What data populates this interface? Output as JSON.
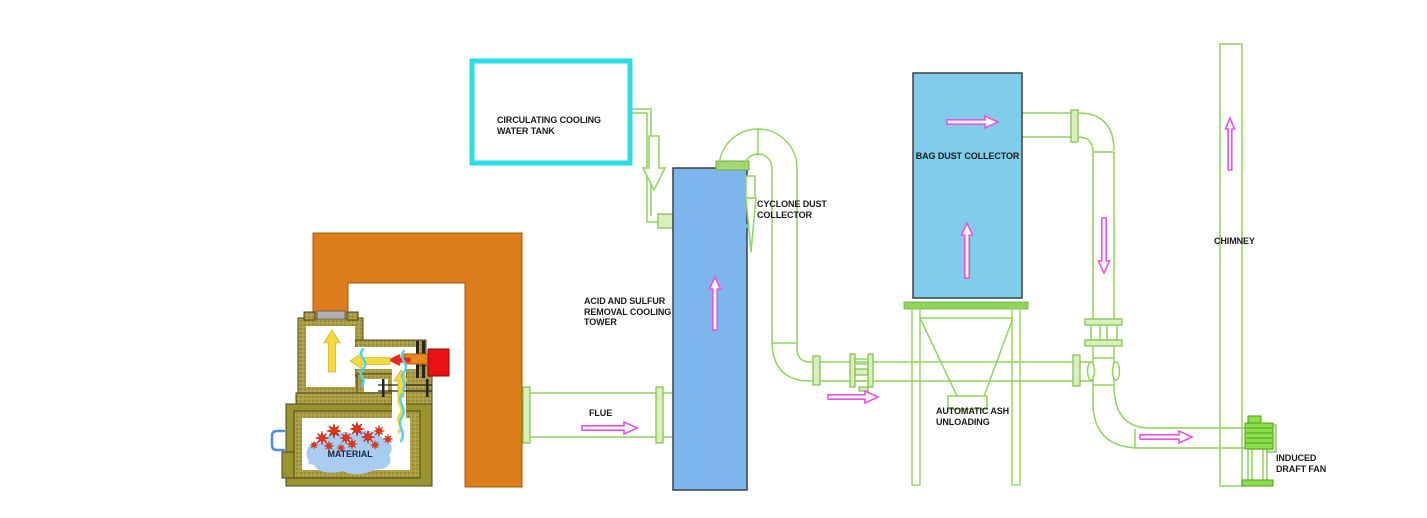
{
  "diagram": {
    "type": "process-flow",
    "background": "#ffffff",
    "components": {
      "water_tank": {
        "label": "CIRCULATING COOLING\nWATER TANK"
      },
      "cooling_tower": {
        "label": "ACID AND SULFUR\nREMOVAL COOLING\nTOWER"
      },
      "cyclone": {
        "label": "CYCLONE DUST\nCOLLECTOR"
      },
      "flue": {
        "label": "FLUE"
      },
      "bag_dust_collector": {
        "label": "BAG DUST COLLECTOR"
      },
      "ash_unloading": {
        "label": "AUTOMATIC ASH\nUNLOADING"
      },
      "chimney": {
        "label": "CHIMNEY"
      },
      "induced_draft_fan": {
        "label": "INDUCED\nDRAFT FAN"
      },
      "furnace_material": {
        "label": "MATERIAL"
      }
    },
    "colors": {
      "pipe_green": "#8fd45c",
      "flow_arrow_pink": "#e951e6",
      "tank_border_cyan": "#2adee8",
      "tower_blue": "#7db6ec",
      "bag_collector_blue": "#80cdea",
      "gantry_orange": "#dd7c1b",
      "furnace_khaki": "#ab9e44",
      "furnace_olive": "#99942e",
      "flame_red": "#e83212",
      "burner_red": "#e81212",
      "heat_arrow_yellow": "#f4d83c",
      "water_cyan": "#4fd2ea",
      "material_blue": "#a9cdf1",
      "label_text": "#1a1a1a"
    }
  }
}
